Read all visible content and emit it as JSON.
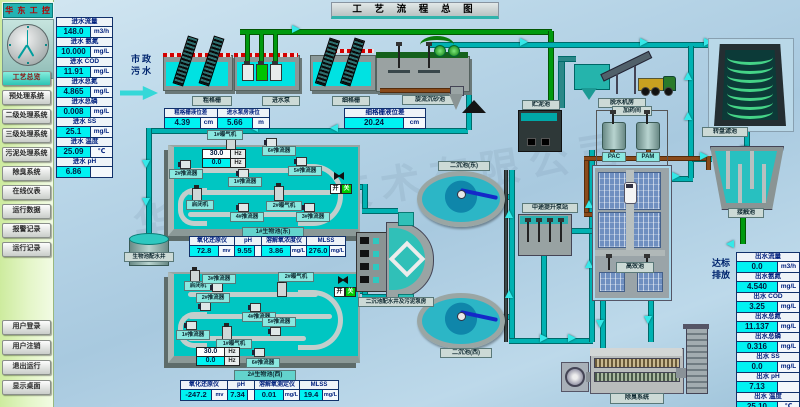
{
  "window": {
    "title": "工 艺 流 程 总 图"
  },
  "logo": {
    "text": "华 东 工 控"
  },
  "watermark": "华东工控技术有限公司",
  "sidebar": {
    "nav_items": [
      "工艺总览",
      "预处理系统",
      "二级处理系统",
      "三级处理系统",
      "污泥处理系统",
      "除臭系统",
      "在线仪表",
      "运行数据",
      "报警记录",
      "运行记录"
    ],
    "active_index": 0,
    "session_items": [
      "用户登录",
      "用户注销",
      "退出运行",
      "显示桌面"
    ]
  },
  "inlet_panel": {
    "params": [
      {
        "label": "进水流量",
        "value": "148.0",
        "unit": "m3/h"
      },
      {
        "label": "进水 氨氮",
        "value": "10.000",
        "unit": "mg/L"
      },
      {
        "label": "进水 COD",
        "value": "11.91",
        "unit": "mg/L"
      },
      {
        "label": "进水总氮",
        "value": "4.865",
        "unit": "mg/L"
      },
      {
        "label": "进水总磷",
        "value": "0.008",
        "unit": "mg/L"
      },
      {
        "label": "进水 SS",
        "value": "25.1",
        "unit": "mg/L"
      },
      {
        "label": "进水 温度",
        "value": "25.09",
        "unit": "℃"
      },
      {
        "label": "进水 pH",
        "value": "6.86",
        "unit": ""
      }
    ]
  },
  "outlet_panel": {
    "note_line1": "达标",
    "note_line2": "排放",
    "params": [
      {
        "label": "出水流量",
        "value": "0.0",
        "unit": "m3/h"
      },
      {
        "label": "出水氨氮",
        "value": "4.540",
        "unit": "mg/L"
      },
      {
        "label": "出水 COD",
        "value": "3.25",
        "unit": "mg/L"
      },
      {
        "label": "出水总氮",
        "value": "11.137",
        "unit": "mg/L"
      },
      {
        "label": "出水总磷",
        "value": "0.316",
        "unit": "mg/L"
      },
      {
        "label": "出水 SS",
        "value": "0.0",
        "unit": "mg/L"
      },
      {
        "label": "出水 pH",
        "value": "7.13",
        "unit": ""
      },
      {
        "label": "出水 温度",
        "value": "25.10",
        "unit": "℃"
      }
    ]
  },
  "pretreatment": {
    "influent_line1": "市政",
    "influent_line2": "污水",
    "coarse_screen": "粗格栅",
    "inlet_pump": "进水泵",
    "fine_screen": "细格栅",
    "grit_chamber": "旋流沉砂池",
    "measurements": [
      {
        "label": "粗格栅液位差",
        "value": "4.39",
        "unit": "cm"
      },
      {
        "label": "进水泵房液位",
        "value": "5.66",
        "unit": "m"
      },
      {
        "label": "细格栅液位差",
        "value": "20.24",
        "unit": "cm"
      }
    ]
  },
  "sludge": {
    "storage_tank": "贮泥池",
    "dewatering_room": "脱水机房",
    "dosing_room": "加药间",
    "pac_tank": "PAC",
    "pam_tank": "PAM"
  },
  "ditch1": {
    "name": "1#生物池(东)",
    "freq": [
      {
        "value": "30.0",
        "unit": "Hz"
      },
      {
        "value": "0.0",
        "unit": "Hz"
      }
    ],
    "devices": {
      "aer1": "1#曝气机",
      "aer2": "2#曝气机",
      "hoist": "启闭机",
      "p1": "1#推流器",
      "p2": "2#推流器",
      "p3": "3#推流器",
      "p4": "4#推流器",
      "p5": "5#推流器",
      "p6": "6#推流器"
    },
    "monitors": [
      {
        "label": "氧化还原仪",
        "value": "72.8",
        "unit": "mv"
      },
      {
        "label": "pH",
        "value": "9.55",
        "unit": ""
      },
      {
        "label": "溶解氧浓度仪",
        "value": "3.86",
        "unit": "mg/L"
      },
      {
        "label": "MLSS",
        "value": "276.0",
        "unit": "mg/L"
      }
    ]
  },
  "ditch2": {
    "name": "2#生物池(西)",
    "freq": [
      {
        "value": "30.0",
        "unit": "Hz"
      },
      {
        "value": "0.0",
        "unit": "Hz"
      }
    ],
    "devices": {
      "aer1": "1#曝气机",
      "aer2": "2#曝气机",
      "hoist": "启闭机",
      "p1": "1#推流器",
      "p2": "2#推流器",
      "p3": "3#推流器",
      "p4": "4#推流器",
      "p5": "5#推流器",
      "p6": "6#推流器"
    },
    "monitors": [
      {
        "label": "氧化还原仪",
        "value": "-247.2",
        "unit": "mv"
      },
      {
        "label": "pH",
        "value": "7.34",
        "unit": ""
      },
      {
        "label": "溶解氧测定仪",
        "value": "0.01",
        "unit": "mg/L"
      },
      {
        "label": "MLSS",
        "value": "19.4",
        "unit": "mg/L"
      }
    ]
  },
  "secondary": {
    "clarifier_east": "二沉池(东)",
    "clarifier_west": "二沉池(西)",
    "distribution_well": "二沉池配水井及污泥泵房",
    "lift_station": "中途提升泵站",
    "bio_distribution_well": "生物池配水井",
    "gate_open": "开",
    "gate_closed": "关"
  },
  "tertiary": {
    "high_eff_tank": "高效池",
    "contact_tank": "接触池",
    "disc_filter": "转盘滤池",
    "deodor_system": "除臭系统"
  },
  "colors": {
    "value_bg": "#00f2f2",
    "label_text": "#00207e",
    "pipe_teal": "#00b2b2",
    "pipe_green": "#009a0e",
    "active_button": "#2cc4b4",
    "logo_bg": "#23b3b3"
  }
}
